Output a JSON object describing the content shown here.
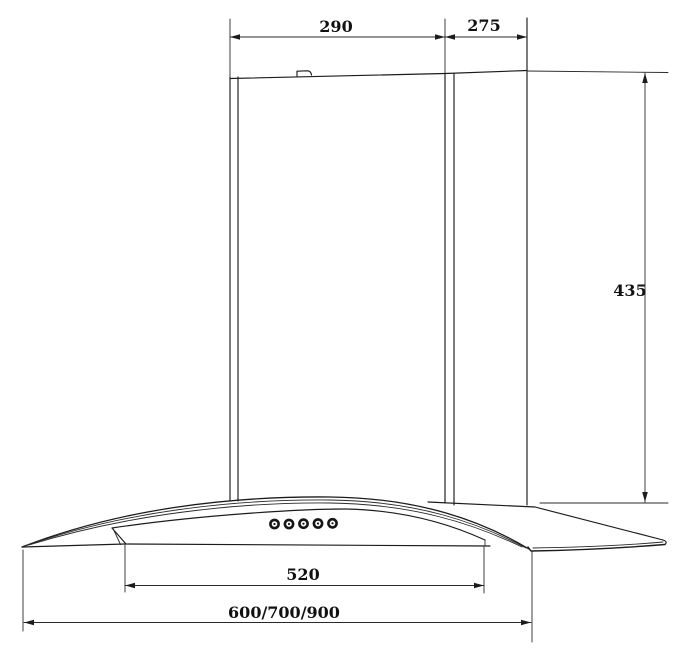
{
  "meta": {
    "type": "technical-dimension-drawing",
    "subject": "wall-mounted curved-glass cooker hood, front view with chimney and rear duct",
    "control_buttons": 5,
    "colors": {
      "line": "#1c1c1c",
      "background": "#ffffff",
      "text": "#111111"
    }
  },
  "dims": {
    "chimney_top_width": "290",
    "duct_top_depth": "275",
    "chimney_height": "435",
    "glass_inner_width": "520",
    "overall_widths": "600/700/900"
  }
}
